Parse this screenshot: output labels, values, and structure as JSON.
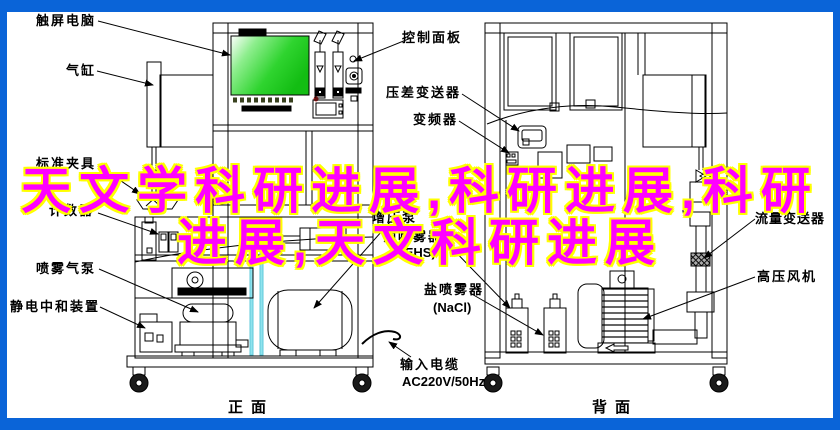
{
  "colors": {
    "frame_blue": "#0a64d8",
    "overlay_text": "#ff00ff",
    "overlay_outline": "#ffff00",
    "screen_green": "#2bd62b",
    "pipe_cyan": "#8fe3ee",
    "line_black": "#000000"
  },
  "overlay_title": {
    "line1": "天文学科研进展,科研进展,科研",
    "line2": "进展,天文科研进展"
  },
  "front_view": {
    "caption": "正面",
    "labels": {
      "touch_screen_pc": "触屏电脑",
      "air_cylinder": "气缸",
      "standard_fixture": "标准夹具",
      "counter": "计数器",
      "spray_air_pump": "喷雾气泵",
      "static_neutralizer": "静电中和装置"
    }
  },
  "center_labels": {
    "control_panel": "控制面板",
    "diff_pressure_transmitter": "压差变送器",
    "frequency_inverter": "变频器",
    "booster_pump": "增压泵",
    "oil_sprayer": "油喷雾器",
    "oil_sprayer_medium": "(DEHS)",
    "salt_sprayer": "盐喷雾器",
    "salt_sprayer_medium": "(NaCl)",
    "input_cable": "输入电缆",
    "input_cable_spec": "AC220V/50Hz"
  },
  "back_view": {
    "caption": "背面",
    "labels": {
      "flow_transmitter": "流量变送器",
      "high_pressure_blower": "高压风机"
    }
  }
}
